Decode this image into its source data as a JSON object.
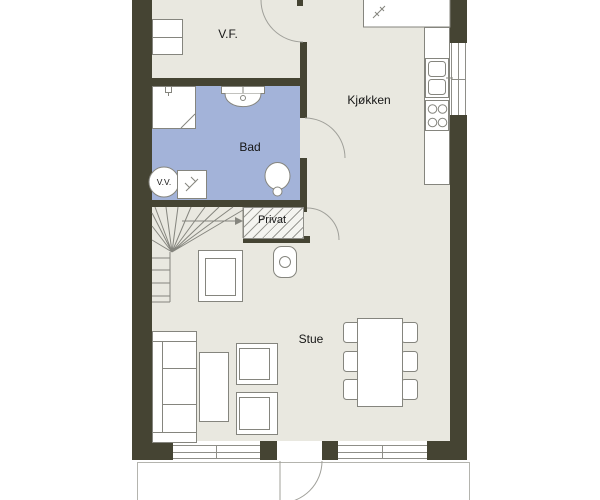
{
  "plan": {
    "rooms": [
      {
        "id": "vf",
        "label": "V.F."
      },
      {
        "id": "kjokken",
        "label": "Kjøkken"
      },
      {
        "id": "bad",
        "label": "Bad"
      },
      {
        "id": "vv",
        "label": "V.V."
      },
      {
        "id": "privat",
        "label": "Privat"
      },
      {
        "id": "stue",
        "label": "Stue"
      }
    ],
    "colors": {
      "wall": "#454433",
      "floor": "#e9e8e0",
      "bathroom_floor": "#a3b3d9",
      "outline": "#8e8e88",
      "background": "#ffffff",
      "text": "#161616"
    },
    "fixtures": [
      "entrance-door",
      "wardrobe",
      "kitchen-counter",
      "kitchen-sink",
      "stove",
      "shower",
      "floor-drain",
      "bathroom-sink",
      "toilet",
      "water-heater",
      "washing-machine",
      "stairs",
      "stairs-direction-arrow",
      "privat-storage",
      "privat-door",
      "bathroom-door",
      "armchair",
      "side-table",
      "sofa",
      "coffee-table",
      "living-armchairs",
      "dining-table",
      "dining-chairs",
      "patio-door",
      "terrace",
      "windows"
    ]
  }
}
